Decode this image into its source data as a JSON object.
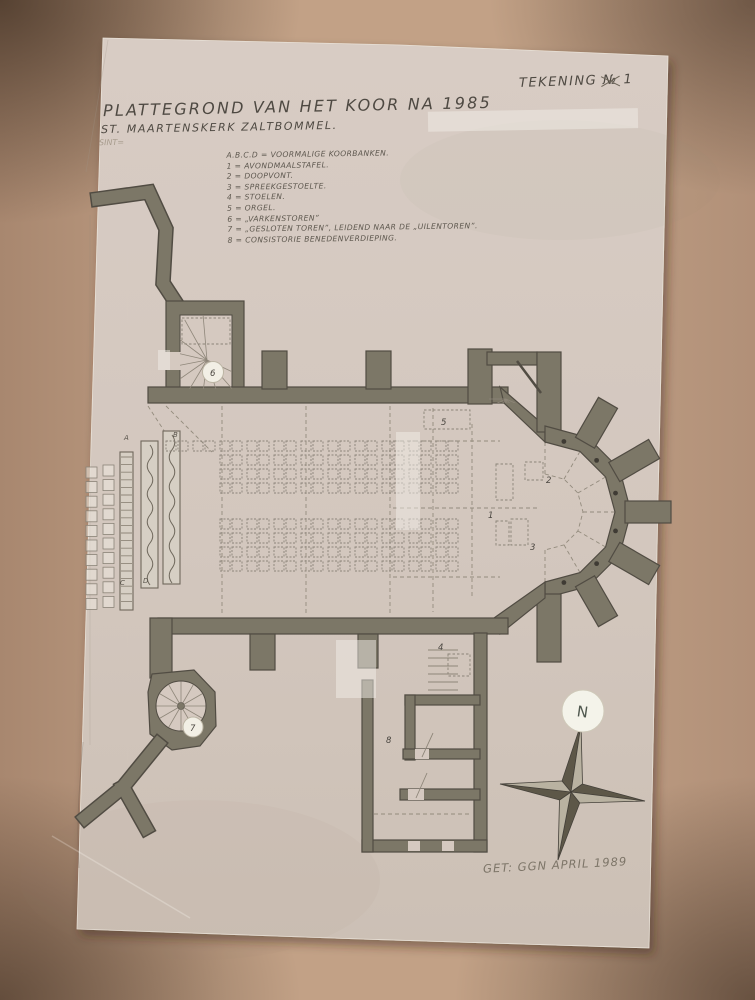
{
  "header": {
    "drawing_no": {
      "prefix": "TEKENING",
      "nr_symbol": "№",
      "number": "1"
    },
    "title": "PLATTEGROND VAN HET KOOR NA 1985",
    "subtitle": "ST. MAARTENSKERK ZALTBOMMEL.",
    "note": "SINT="
  },
  "legend": {
    "items": [
      "A.B.C.D = VOORMALIGE KOORBANKEN.",
      "1 = AVONDMAALSTAFEL.",
      "2 = DOOPVONT.",
      "3 = SPREEKGESTOELTE.",
      "4 = STOELEN.",
      "5 = ORGEL.",
      "6 = „VARKENSTOREN”",
      "7 = „GESLOTEN TOREN”, LEIDEND NAAR DE „UILENTOREN”.",
      "8 = CONSISTORIE BENEDENVERDIEPING."
    ]
  },
  "plan": {
    "labels": {
      "table": "1",
      "font": "2",
      "pulpit": "3",
      "chairs": "4",
      "organ": "5",
      "tower_nw": "6",
      "tower_sw": "7",
      "consistory": "8",
      "bench_letters": [
        "A",
        "B",
        "C",
        "D"
      ]
    }
  },
  "compass": {
    "north": "N"
  },
  "footer": {
    "signature": "GET: GGN APRIL 1989"
  },
  "colors": {
    "cardboard": "#b5947c",
    "paper": "#d5c9c0",
    "wall": "#7c7767",
    "ink": "#4e4942",
    "pencil": "#8e8679",
    "disc": "#f2efe5"
  }
}
